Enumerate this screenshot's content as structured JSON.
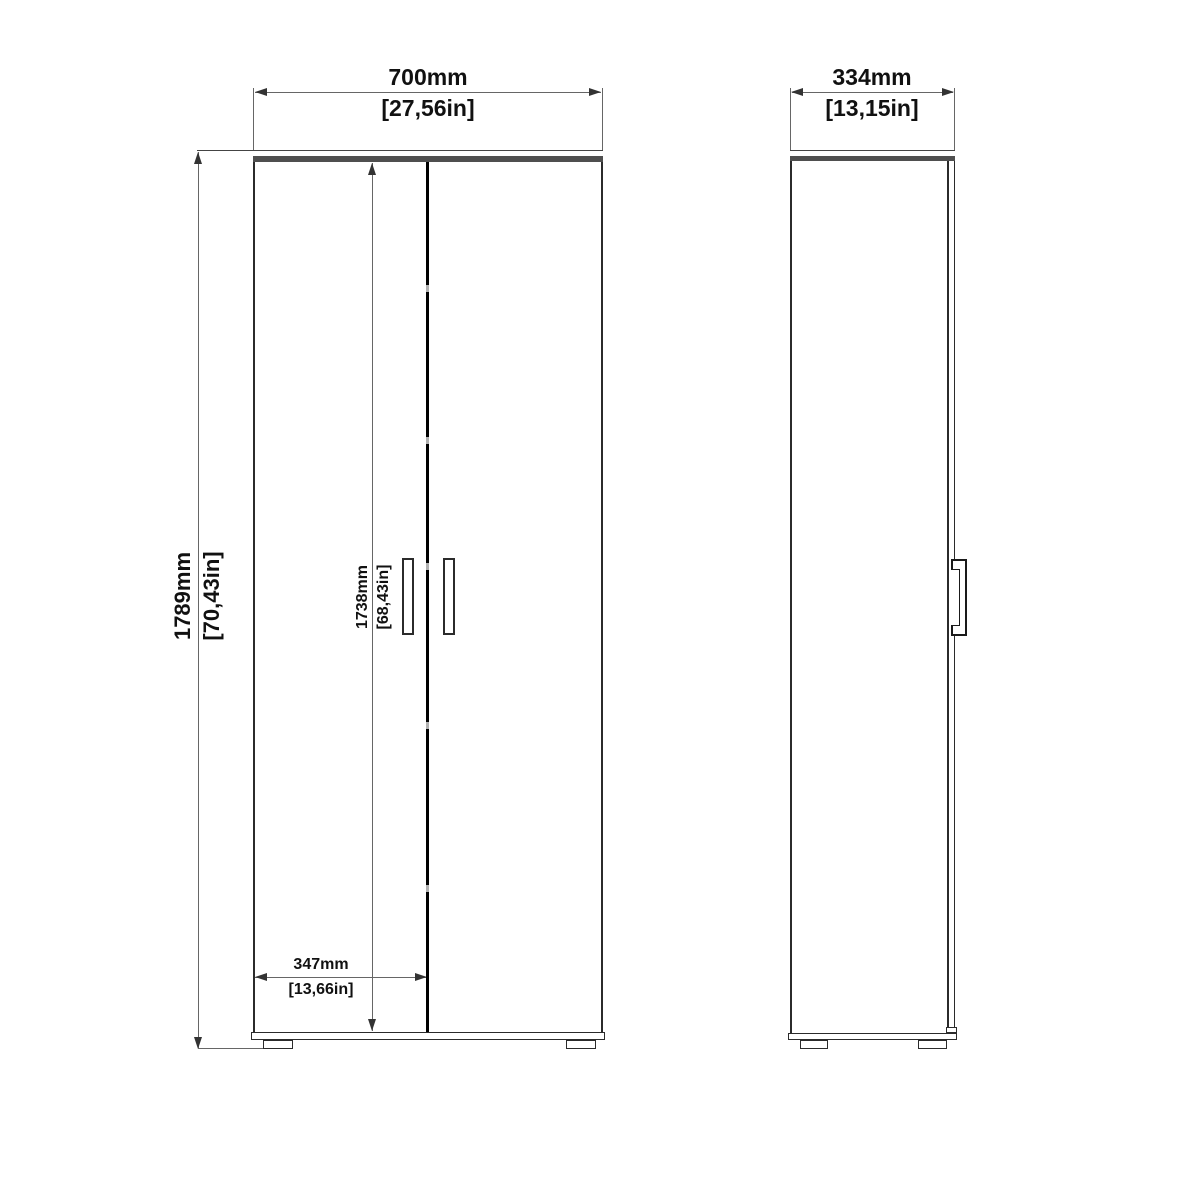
{
  "colors": {
    "bg": "#ffffff",
    "line": "#2b2b2b",
    "dim": "#666666",
    "band": "#4f4f4f",
    "gap": "#000000",
    "mark": "#b0b0b0",
    "text": "#111111"
  },
  "front": {
    "width": {
      "mm": "700mm",
      "inch": "[27,56in]"
    },
    "height": {
      "mm": "1789mm",
      "inch": "[70,43in]"
    },
    "door_height": {
      "mm": "1738mm",
      "inch": "[68,43in]"
    },
    "door_width": {
      "mm": "347mm",
      "inch": "[13,66in]"
    }
  },
  "side": {
    "depth": {
      "mm": "334mm",
      "inch": "[13,15in]"
    }
  }
}
